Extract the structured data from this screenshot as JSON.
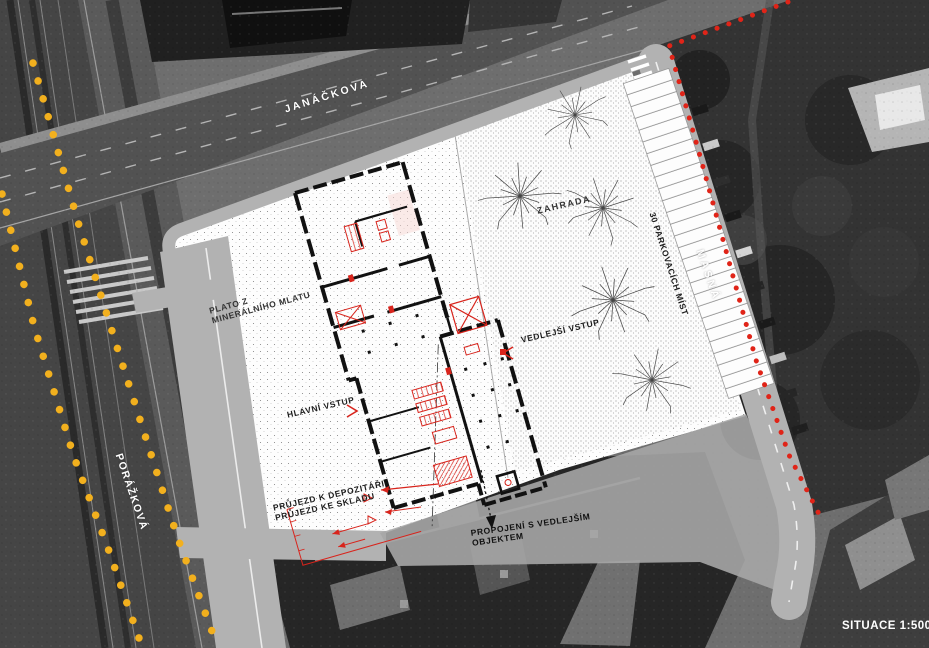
{
  "drawing": {
    "streets": {
      "top": "JANÁČKOVA",
      "right": "MASNÁ",
      "left": "PORÁŽKOVÁ"
    },
    "areas": {
      "garden": "ZAHRADA",
      "parking": "30 PARKOVACÍCH MÍST",
      "plateau_line1": "PLATO Z",
      "plateau_line2": "MINERÁLNÍHO MLATU"
    },
    "annotations": {
      "main_entrance": "HLAVNÍ VSTUP",
      "side_entrance": "VEDLEJŠÍ VSTUP",
      "passage_line1": "PRŮJEZD K DEPOZITÁŘI",
      "passage_line2": "PRŮJEZD KE SKLADU",
      "connection_line1": "PROPOJENÍ S VEDLEJŠÍM",
      "connection_line2": "OBJEKTEM"
    },
    "scale_label": "SITUACE 1:500",
    "colors": {
      "site_boundary_red": "#e02418",
      "route_yellow": "#f2b01e",
      "plan_red": "#d8241c"
    }
  }
}
